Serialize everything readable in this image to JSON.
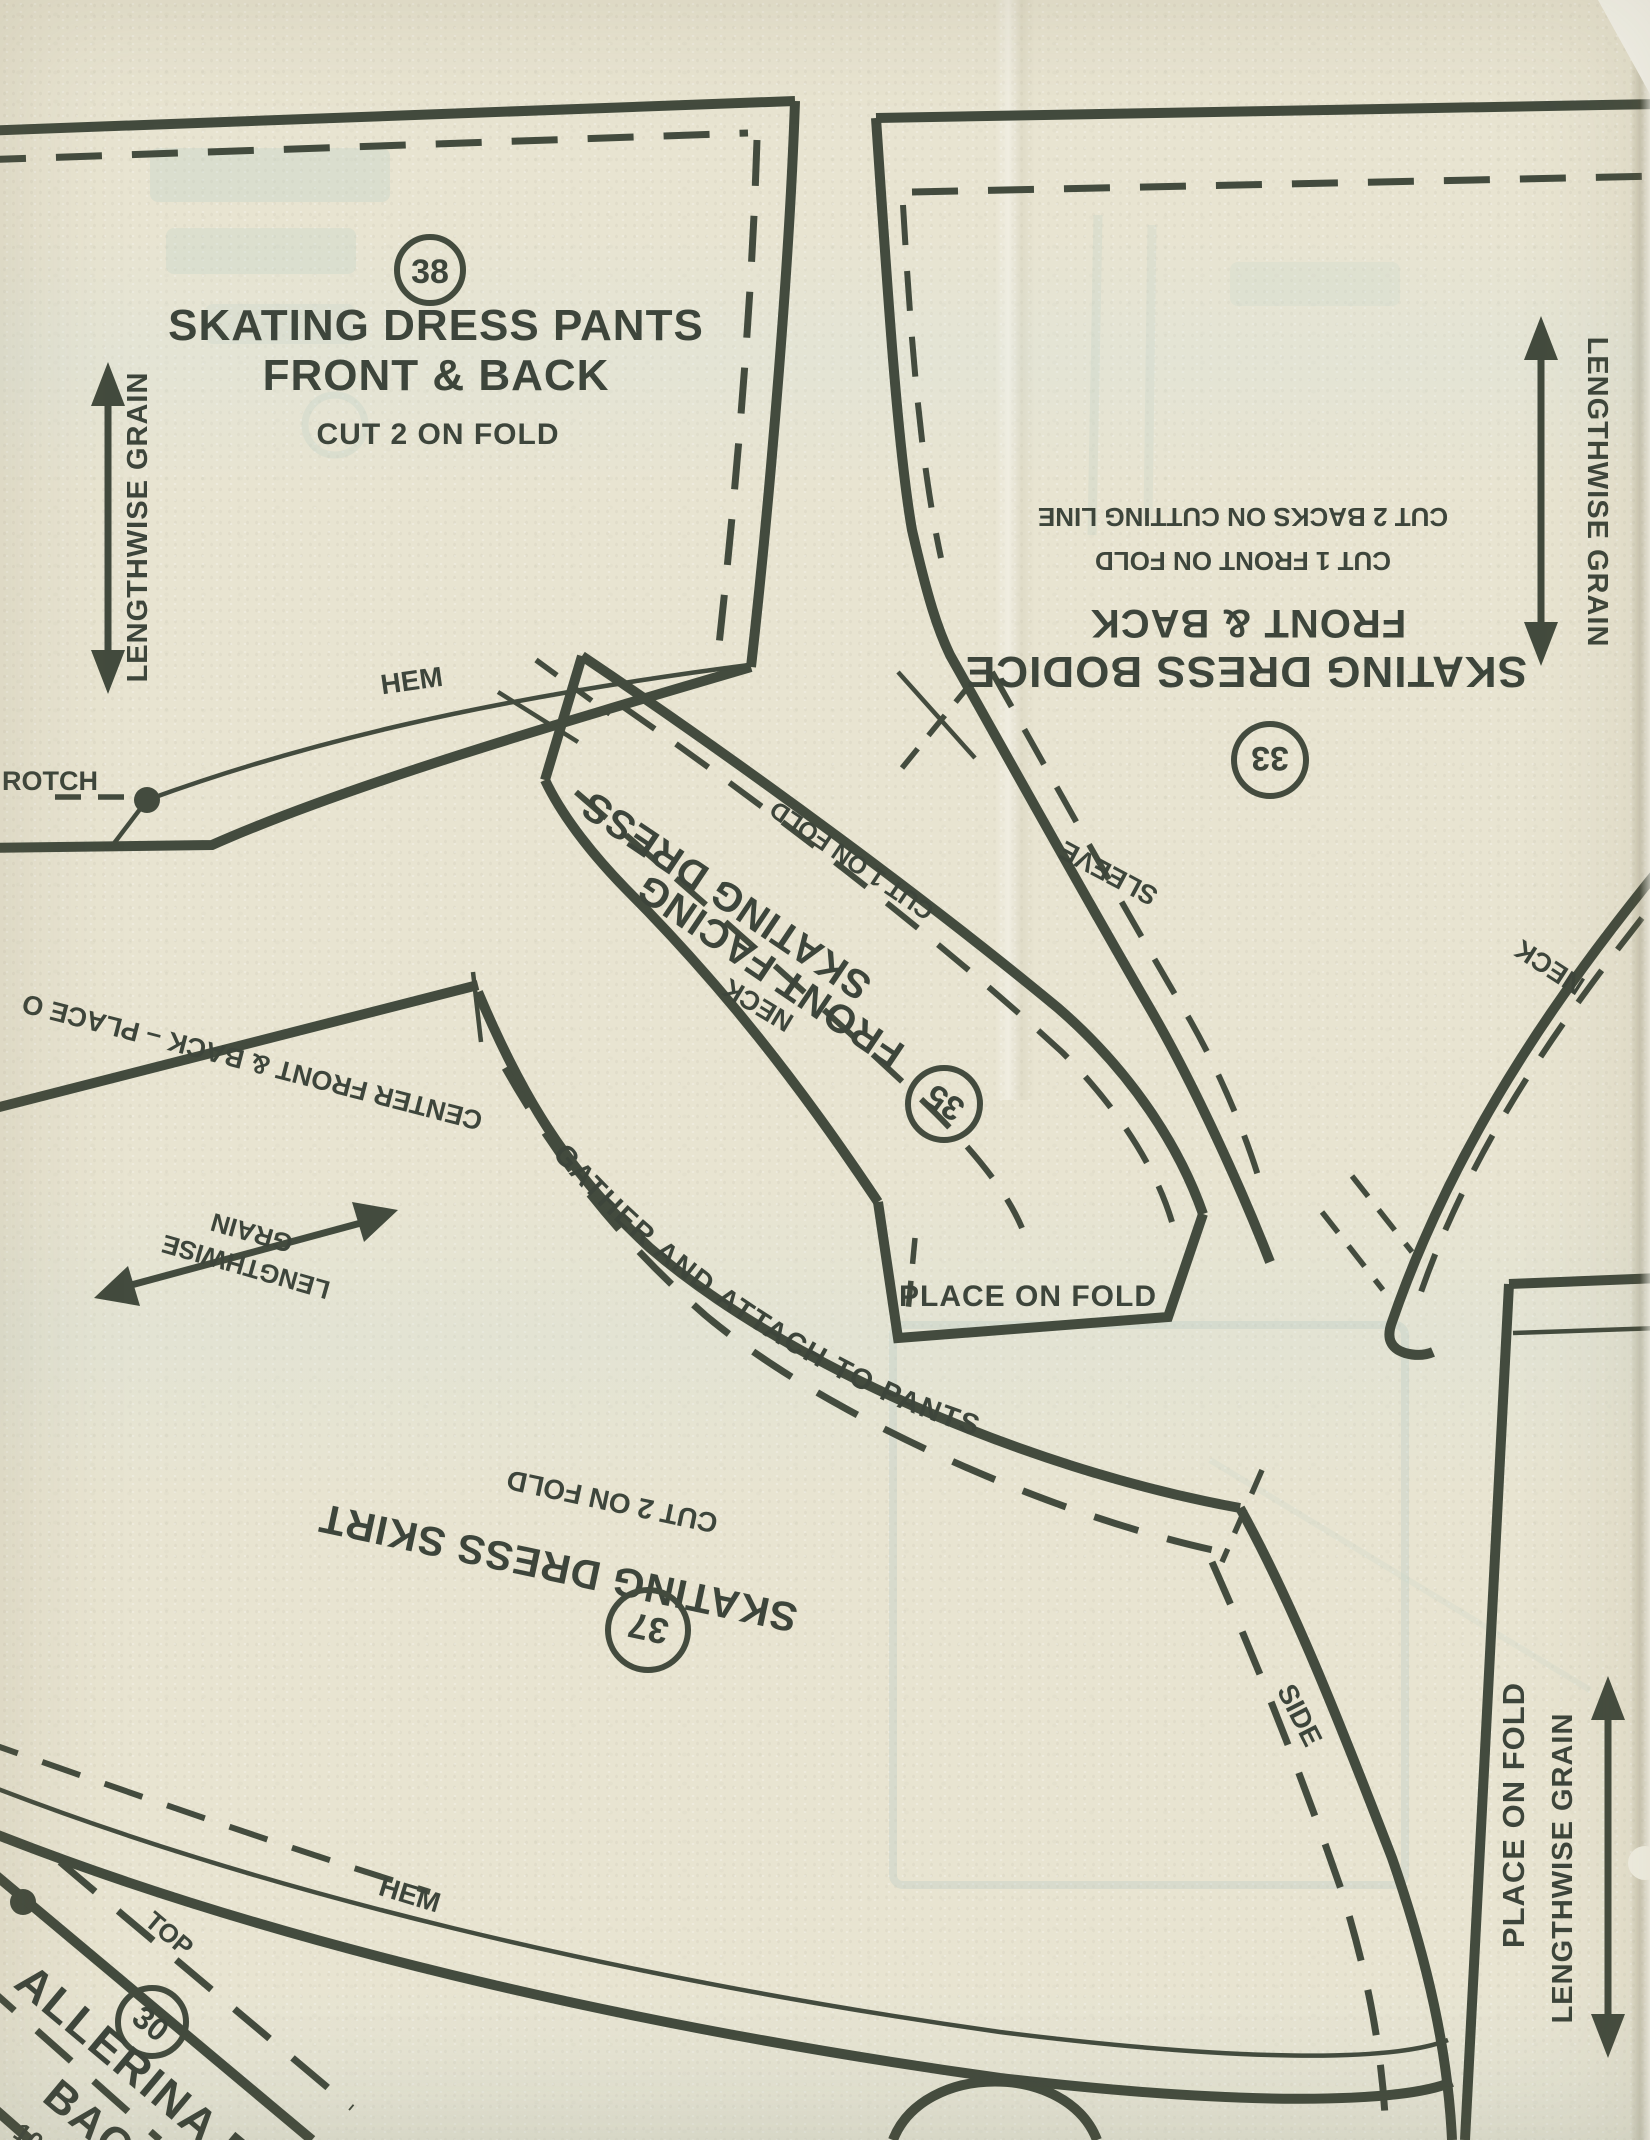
{
  "paper": {
    "background": "#e8e4d1",
    "ink": "#3d453b",
    "ghost": "#b3cbc4"
  },
  "pants": {
    "number": "38",
    "title_line1": "SKATING DRESS PANTS",
    "title_line2": "FRONT & BACK",
    "cut_note": "CUT 2 ON FOLD",
    "grain_label": "LENGTHWISE GRAIN",
    "hem_label": "HEM",
    "crotch_label": "ROTCH"
  },
  "bodice": {
    "number": "33",
    "title": "SKATING DRESS BODICE",
    "subtitle": "FRONT & BACK",
    "cut_note1": "CUT 1 FRONT ON FOLD",
    "cut_note2": "CUT 2 BACKS ON CUTTING LINE",
    "grain_label": "LENGTHWISE GRAIN",
    "sleeve_label": "SLEEVE",
    "neck_label": "NECK"
  },
  "facing": {
    "number": "35",
    "title_line1": "SKATING DRESS",
    "title_line2": "FRONT FACING",
    "cut_note": "CUT 1 ON FOLD",
    "neck_label": "NECK",
    "fold_label": "PLACE ON FOLD"
  },
  "skirt": {
    "number": "37",
    "title": "SKATING DRESS SKIRT",
    "cut_note": "CUT 2 ON FOLD",
    "gather_label": "GATHER AND ATTACH TO PANTS",
    "hem_label": "HEM",
    "side_label": "SIDE",
    "center_label": "CENTER FRONT & BACK – PLACE O",
    "grain_word1": "GRAIN",
    "grain_word2": "LENGTHWISE"
  },
  "ballerina": {
    "number": "30",
    "top_label": "TOP",
    "name_partial": "ALLERINA BO",
    "name_partial2": "BACK",
    "digits_partial": "10"
  },
  "fold_piece": {
    "fold_label": "PLACE ON FOLD",
    "grain_label": "LENGTHWISE GRAIN"
  }
}
